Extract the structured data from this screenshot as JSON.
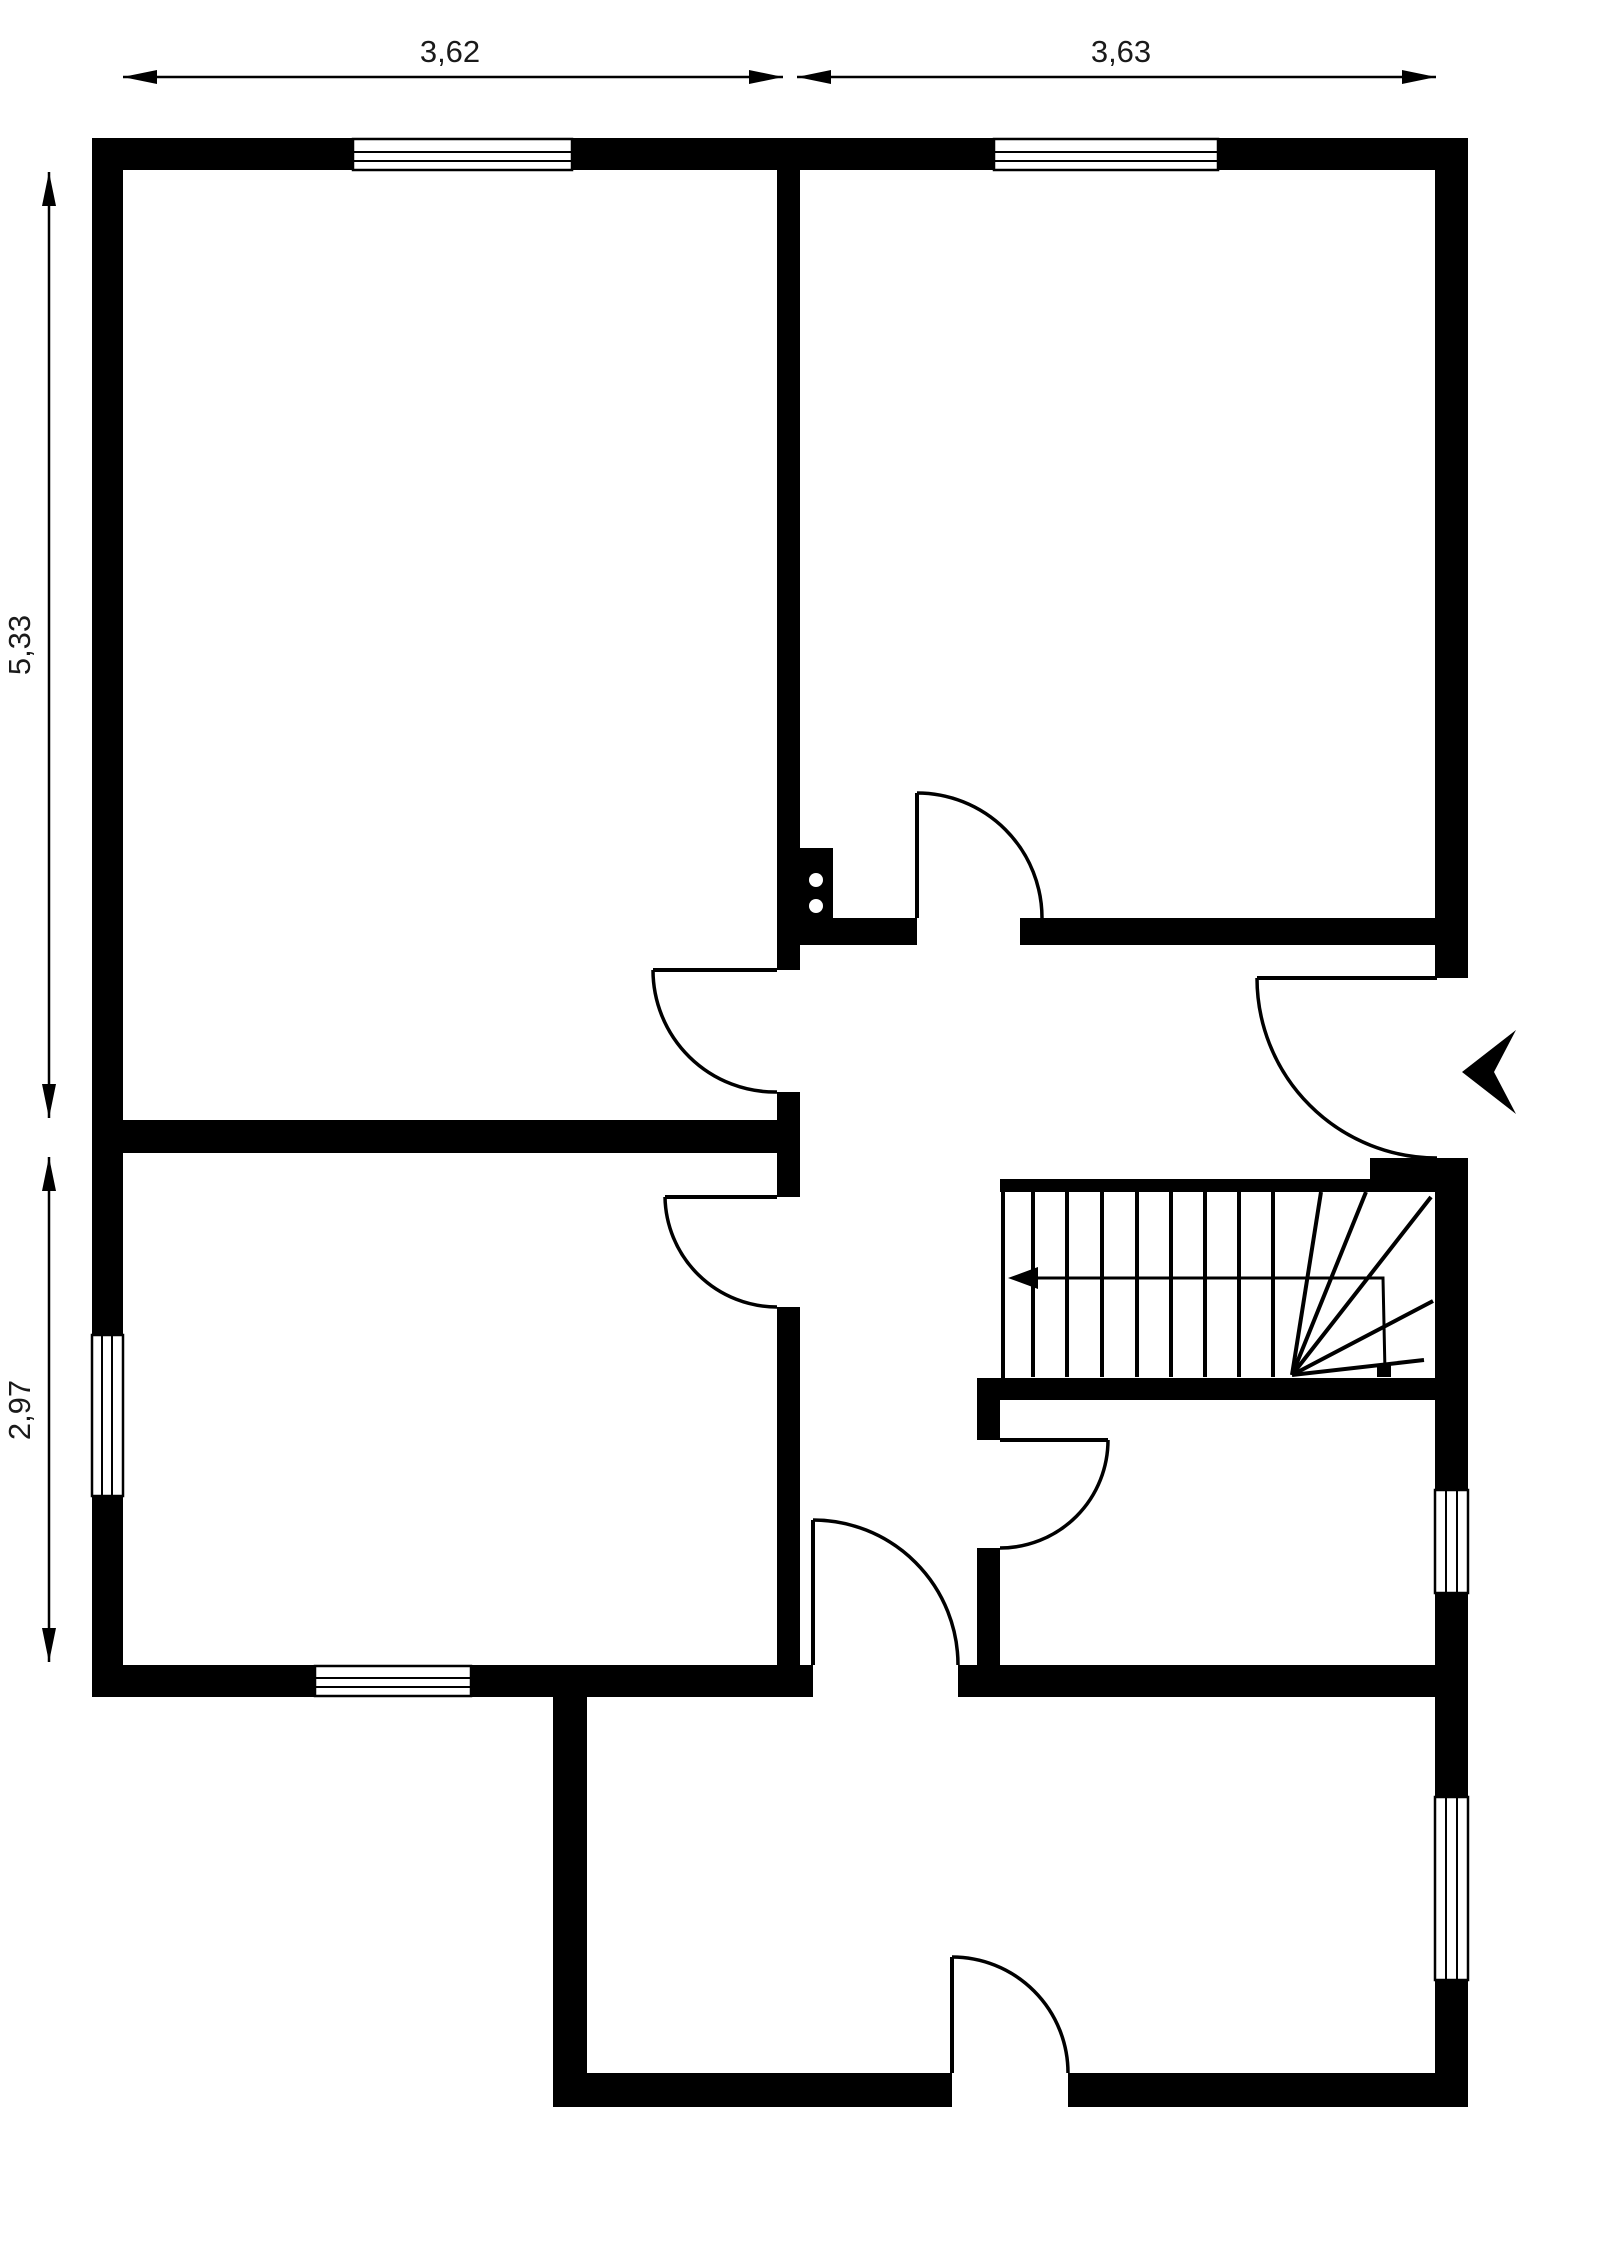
{
  "plan": {
    "canvas": {
      "w": 1600,
      "h": 2264,
      "background": "#ffffff",
      "ink": "#000000",
      "label_color": "#1a1a1a",
      "label_font_size": 31
    },
    "dimensions": [
      {
        "name": "dim-top-left",
        "label": "3,62",
        "x1": 123,
        "y1": 77,
        "x2": 783,
        "y2": 77,
        "label_x": 450,
        "label_y": 62,
        "rotate": 0
      },
      {
        "name": "dim-top-right",
        "label": "3,63",
        "x1": 797,
        "y1": 77,
        "x2": 1436,
        "y2": 77,
        "label_x": 1121,
        "label_y": 62,
        "rotate": 0
      },
      {
        "name": "dim-left-upper",
        "label": "5,33",
        "x1": 49,
        "y1": 172,
        "x2": 49,
        "y2": 1118,
        "label_x": 30,
        "label_y": 645,
        "rotate": -90
      },
      {
        "name": "dim-left-lower",
        "label": "2,97",
        "x1": 49,
        "y1": 1157,
        "x2": 49,
        "y2": 1662,
        "label_x": 30,
        "label_y": 1410,
        "rotate": -90
      }
    ],
    "walls": [
      {
        "name": "wall-exterior-top",
        "rect": [
          92,
          138,
          1376,
          32
        ]
      },
      {
        "name": "wall-exterior-left",
        "rect": [
          92,
          170,
          31,
          1495
        ]
      },
      {
        "name": "wall-exterior-right-seg1",
        "rect": [
          1435,
          170,
          33,
          808
        ]
      },
      {
        "name": "wall-exterior-right-seg2",
        "rect": [
          1435,
          1158,
          33,
          332
        ]
      },
      {
        "name": "wall-exterior-right-seg3",
        "rect": [
          1435,
          1593,
          33,
          204
        ]
      },
      {
        "name": "wall-exterior-right-seg4",
        "rect": [
          1435,
          1980,
          33,
          127
        ]
      },
      {
        "name": "wall-bottom-left",
        "rect": [
          92,
          1665,
          721,
          32
        ]
      },
      {
        "name": "wall-bottom-mid-right",
        "rect": [
          958,
          1665,
          477,
          32
        ]
      },
      {
        "name": "wall-rear-extension-left",
        "rect": [
          553,
          1697,
          34,
          410
        ]
      },
      {
        "name": "wall-rear-extension-bottom-a",
        "rect": [
          553,
          2073,
          399,
          34
        ]
      },
      {
        "name": "wall-rear-extension-bottom-b",
        "rect": [
          1068,
          2073,
          367,
          34
        ]
      },
      {
        "name": "wall-interior-center-seg1",
        "rect": [
          777,
          170,
          23,
          800
        ]
      },
      {
        "name": "wall-interior-center-seg2",
        "rect": [
          777,
          1092,
          23,
          105
        ]
      },
      {
        "name": "wall-interior-center-seg3",
        "rect": [
          777,
          1307,
          23,
          358
        ]
      },
      {
        "name": "wall-interior-left-divider",
        "rect": [
          123,
          1120,
          677,
          33
        ]
      },
      {
        "name": "wall-upper-right-room-a",
        "rect": [
          777,
          918,
          140,
          27
        ]
      },
      {
        "name": "wall-upper-right-room-b",
        "rect": [
          1020,
          918,
          415,
          27
        ]
      },
      {
        "name": "wall-stairs-top-thin",
        "rect": [
          1000,
          1179,
          435,
          13
        ]
      },
      {
        "name": "wall-entrance-jamb-block",
        "rect": [
          1370,
          1158,
          67,
          21
        ]
      },
      {
        "name": "wall-stairs-bottom",
        "rect": [
          977,
          1378,
          458,
          22
        ]
      },
      {
        "name": "wall-under-stairs-seg1",
        "rect": [
          977,
          1400,
          23,
          40
        ]
      },
      {
        "name": "wall-under-stairs-seg2",
        "rect": [
          977,
          1548,
          23,
          117
        ]
      }
    ],
    "windows": [
      {
        "name": "window-top-left",
        "rect": [
          353,
          139,
          219,
          31
        ],
        "lines": [
          [
            353,
            152,
            572,
            152
          ],
          [
            353,
            161,
            572,
            161
          ]
        ]
      },
      {
        "name": "window-top-right",
        "rect": [
          994,
          139,
          224,
          31
        ],
        "lines": [
          [
            994,
            152,
            1218,
            152
          ],
          [
            994,
            161,
            1218,
            161
          ]
        ]
      },
      {
        "name": "window-left",
        "rect": [
          92,
          1335,
          31,
          161
        ],
        "lines": [
          [
            102,
            1335,
            102,
            1496
          ],
          [
            112,
            1335,
            112,
            1496
          ]
        ]
      },
      {
        "name": "window-bottom-left",
        "rect": [
          315,
          1666,
          156,
          30
        ],
        "lines": [
          [
            315,
            1678,
            471,
            1678
          ],
          [
            315,
            1687,
            471,
            1687
          ]
        ]
      },
      {
        "name": "window-right-upper",
        "rect": [
          1435,
          1490,
          33,
          103
        ],
        "lines": [
          [
            1446,
            1490,
            1446,
            1593
          ],
          [
            1457,
            1490,
            1457,
            1593
          ]
        ]
      },
      {
        "name": "window-right-lower",
        "rect": [
          1435,
          1797,
          33,
          183
        ],
        "lines": [
          [
            1446,
            1797,
            1446,
            1980
          ],
          [
            1457,
            1797,
            1457,
            1980
          ]
        ]
      }
    ],
    "doors": [
      {
        "name": "door-upper-left-room",
        "leaf": [
          777,
          970,
          653,
          970
        ],
        "arc": "M 653 970 A 122 122 0 0 0 777 1092"
      },
      {
        "name": "door-lower-left-room",
        "leaf": [
          777,
          1197,
          665,
          1197
        ],
        "arc": "M 665 1197 A 112 112 0 0 0 777 1307"
      },
      {
        "name": "door-upper-right-room",
        "leaf": [
          917,
          918,
          917,
          793
        ],
        "arc": "M 917 793 A 125 125 0 0 1 1042 918"
      },
      {
        "name": "door-entrance",
        "leaf": [
          1437,
          978,
          1257,
          978
        ],
        "arc": "M 1257 978 A 180 180 0 0 0 1437 1158"
      },
      {
        "name": "door-under-stairs",
        "leaf": [
          1000,
          1440,
          1108,
          1440
        ],
        "arc": "M 1108 1440 A 108 108 0 0 1 1000 1548"
      },
      {
        "name": "door-hall-to-rear",
        "leaf": [
          813,
          1665,
          813,
          1520
        ],
        "arc": "M 813 1520 A 145 145 0 0 1 958 1665"
      },
      {
        "name": "door-rear-exterior",
        "leaf": [
          952,
          2073,
          952,
          1957
        ],
        "arc": "M 952 1957 A 116 116 0 0 1 1068 2073"
      }
    ],
    "stairs": {
      "name": "staircase",
      "left_border_rect": [
        1001,
        1191,
        4,
        187
      ],
      "tread_y1": 1192,
      "tread_y2": 1377,
      "treads_x": [
        1033,
        1067,
        1102,
        1137,
        1171,
        1205,
        1239,
        1273
      ],
      "winder_center": [
        1292,
        1375
      ],
      "winder_ends": [
        [
          1321,
          1192
        ],
        [
          1366,
          1192
        ],
        [
          1431,
          1197
        ],
        [
          1433,
          1301
        ],
        [
          1424,
          1360
        ]
      ],
      "direction_path": "M 1385 1372 L 1383 1278 L 1012 1278",
      "direction_arrow_points": "1008,1278 1038,1267 1038,1289",
      "start_dot_rect": [
        1377,
        1365,
        14,
        12
      ]
    },
    "entrance_arrow": {
      "name": "entrance-direction-arrow",
      "points": "1462,1072 1516,1030 1494,1072 1516,1114"
    },
    "outlet_symbol": {
      "name": "electrical-outlet-symbol",
      "rect": [
        800,
        848,
        33,
        70
      ],
      "dots": [
        [
          816,
          880
        ],
        [
          816,
          906
        ]
      ],
      "dot_r": 7
    }
  }
}
